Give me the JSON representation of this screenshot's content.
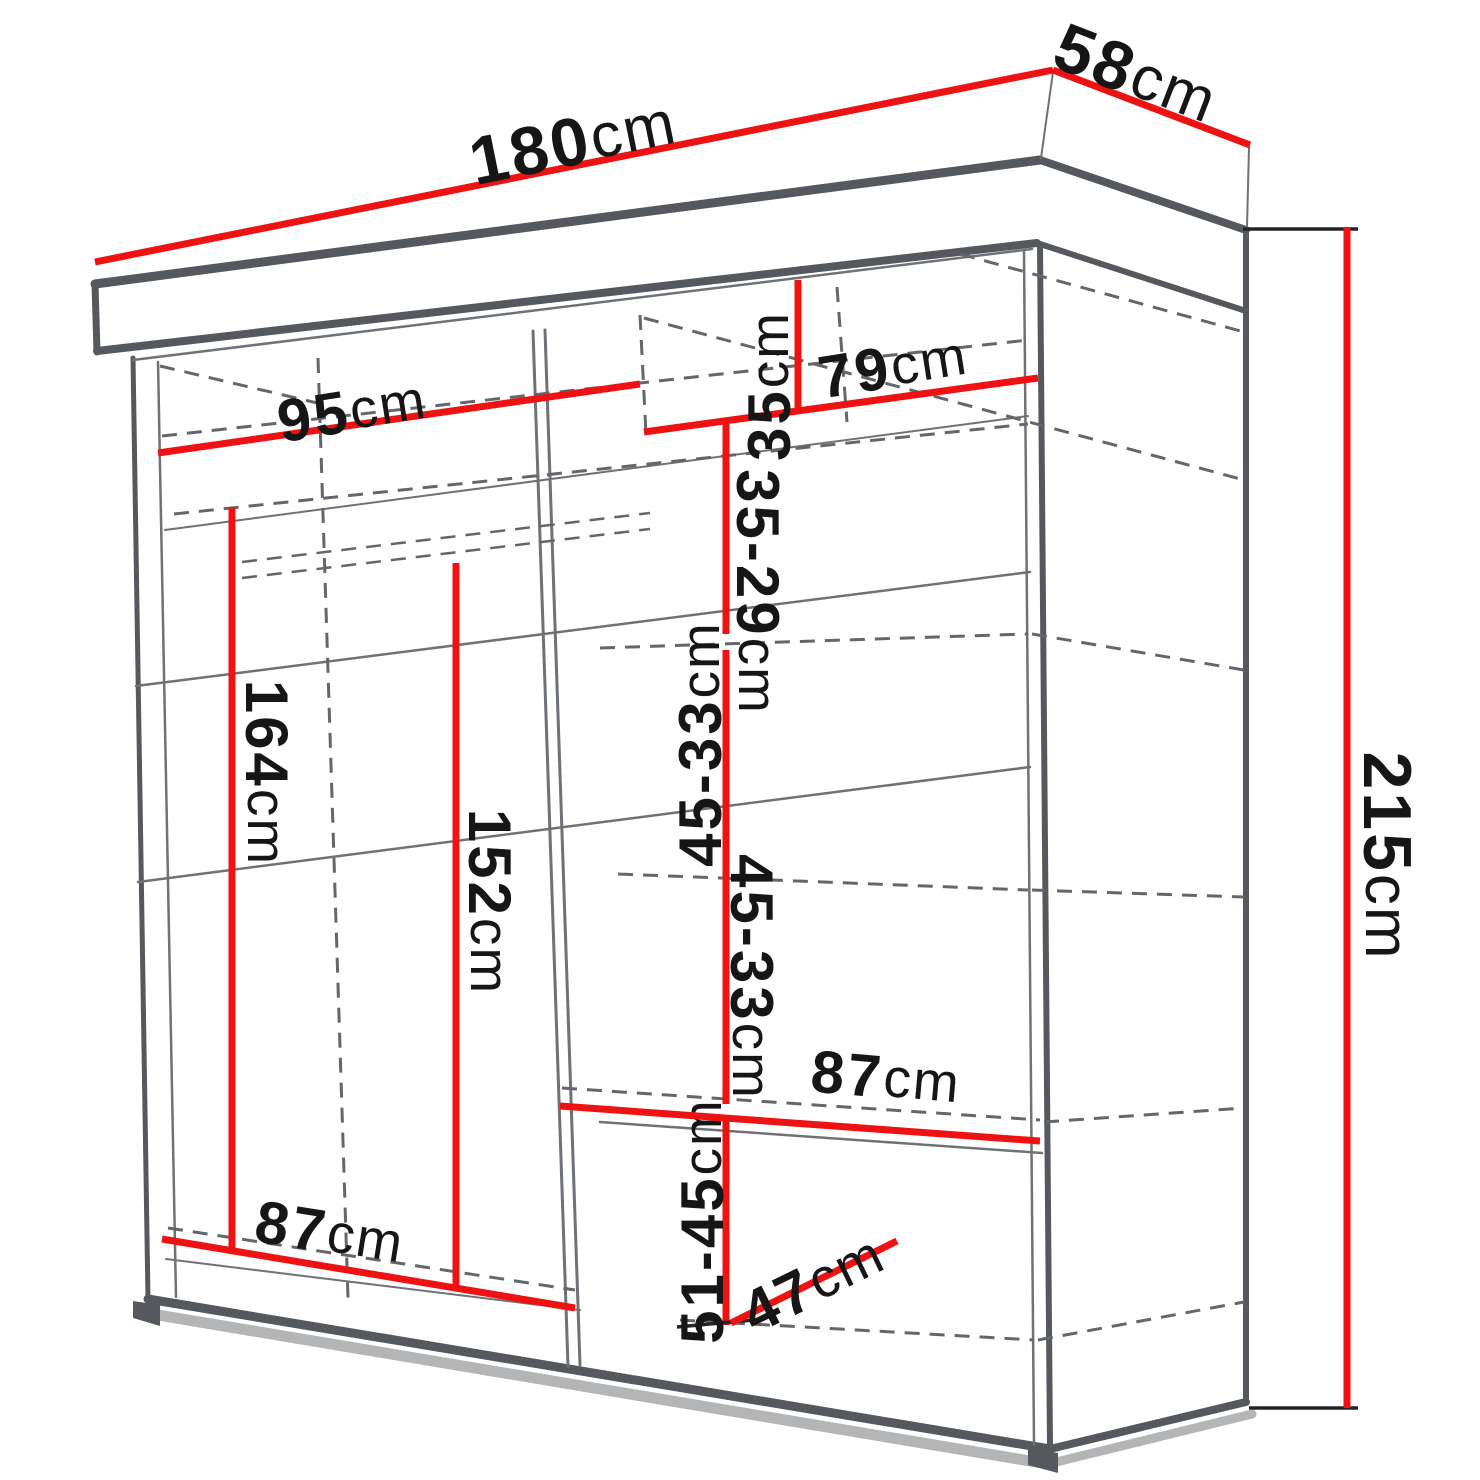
{
  "diagram": {
    "kind": "wardrobe-dimension-diagram",
    "unit": "cm",
    "colors": {
      "accent_red": "#ee1212",
      "outline_gray": "#55585c",
      "dashed_gray": "#63676b",
      "text_black": "#161616",
      "background": "#ffffff"
    },
    "dimensions": {
      "total_width": {
        "value": "180",
        "unit": "cm"
      },
      "total_depth": {
        "value": "58",
        "unit": "cm"
      },
      "total_height": {
        "value": "215",
        "unit": "cm"
      },
      "left_interior_width": {
        "value": "95",
        "unit": "cm"
      },
      "right_interior_width": {
        "value": "79",
        "unit": "cm"
      },
      "top_shelf_height": {
        "value": "35",
        "unit": "cm"
      },
      "shelf_spacing_1": {
        "value": "35-29",
        "unit": "cm"
      },
      "shelf_spacing_2": {
        "value": "45-33",
        "unit": "cm"
      },
      "shelf_spacing_3": {
        "value": "45-33",
        "unit": "cm"
      },
      "shelf_spacing_4": {
        "value": "51-45",
        "unit": "cm"
      },
      "hanging_height_left": {
        "value": "164",
        "unit": "cm"
      },
      "hanging_height_middle": {
        "value": "152",
        "unit": "cm"
      },
      "right_shelf_width": {
        "value": "87",
        "unit": "cm"
      },
      "bottom_left_width": {
        "value": "87",
        "unit": "cm"
      },
      "bottom_right_depth": {
        "value": "47",
        "unit": "cm"
      }
    }
  }
}
